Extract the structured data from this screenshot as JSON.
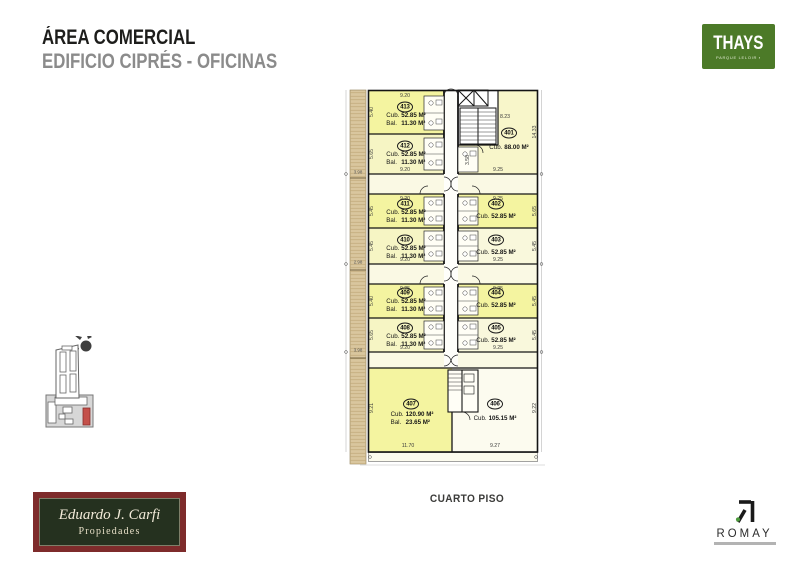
{
  "header": {
    "title": "ÁREA COMERCIAL",
    "subtitle": "EDIFICIO CIPRÉS - OFICINAS"
  },
  "logos": {
    "thays": {
      "name": "THAYS",
      "tagline": "PARQUE LELOIR ▪",
      "bg_color": "#4c7a28"
    },
    "carfi": {
      "line1": "Eduardo J. Carfi",
      "line2": "Propiedades",
      "frame_color": "#7e2b2b",
      "bg_color": "#25311f"
    },
    "romay": {
      "name": "ROMAY",
      "mark": "stylized-R-with-green-dot",
      "accent_color": "#4c9a3c"
    }
  },
  "floor_label": "CUARTO PISO",
  "plan": {
    "unit_fill_bright": "#f4f4a0",
    "unit_fill_light": "#f6f5c4",
    "highlight_red": "#c4504a",
    "units": [
      {
        "number": "413",
        "areas": [
          {
            "label": "Cub.",
            "value": "52.85 M²"
          },
          {
            "label": "Bal.",
            "value": "11.30 M²"
          }
        ],
        "dim_w": "9.20",
        "dim_h": "5.40"
      },
      {
        "number": "412",
        "areas": [
          {
            "label": "Cub.",
            "value": "52.85 M²"
          },
          {
            "label": "Bal.",
            "value": "11.30 M²"
          }
        ],
        "dim_w": "9.20",
        "dim_h": "5.65"
      },
      {
        "number": "411",
        "areas": [
          {
            "label": "Cub.",
            "value": "52.85 M²"
          },
          {
            "label": "Bal.",
            "value": "11.30 M²"
          }
        ],
        "dim_w": "9.20",
        "dim_h": "5.45"
      },
      {
        "number": "410",
        "areas": [
          {
            "label": "Cub.",
            "value": "52.85 M²"
          },
          {
            "label": "Bal.",
            "value": "11.30 M²"
          }
        ],
        "dim_w": "9.20",
        "dim_h": "5.45"
      },
      {
        "number": "409",
        "areas": [
          {
            "label": "Cub.",
            "value": "52.85 M²"
          },
          {
            "label": "Bal.",
            "value": "11.30 M²"
          }
        ],
        "dim_w": "9.25",
        "dim_h": "5.40"
      },
      {
        "number": "408",
        "areas": [
          {
            "label": "Cub.",
            "value": "52.85 M²"
          },
          {
            "label": "Bal.",
            "value": "11.30 M²"
          }
        ],
        "dim_w": "9.20",
        "dim_h": "5.65"
      },
      {
        "number": "407",
        "areas": [
          {
            "label": "Cub.",
            "value": "120.90 M²"
          },
          {
            "label": "Bal.",
            "value": "23.65 M²"
          }
        ],
        "dim_w": "11.70",
        "dim_h": "9.21"
      },
      {
        "number": "401",
        "areas": [
          {
            "label": "Cub.",
            "value": "88.00 M²"
          }
        ],
        "dim_w": "8.23",
        "dim_w2": "9.25",
        "dim_h": "14.33"
      },
      {
        "number": "402",
        "areas": [
          {
            "label": "Cub.",
            "value": "52.85 M²"
          }
        ],
        "dim_w": "9.25",
        "dim_h": "5.65"
      },
      {
        "number": "403",
        "areas": [
          {
            "label": "Cub.",
            "value": "52.85 M²"
          }
        ],
        "dim_w": "9.25",
        "dim_h": "5.45"
      },
      {
        "number": "404",
        "areas": [
          {
            "label": "Cub.",
            "value": "52.85 M²"
          }
        ],
        "dim_w": "9.25",
        "dim_h": "5.45"
      },
      {
        "number": "405",
        "areas": [
          {
            "label": "Cub.",
            "value": "52.85 M²"
          }
        ],
        "dim_w": "9.25",
        "dim_h": "5.45"
      },
      {
        "number": "406",
        "areas": [
          {
            "label": "Cub.",
            "value": "105.15 M²"
          }
        ],
        "dim_w": "9.27",
        "dim_h": "9.22"
      }
    ],
    "extra_dims": [
      "3.58",
      "3.98",
      "2.98",
      "3.98"
    ]
  }
}
